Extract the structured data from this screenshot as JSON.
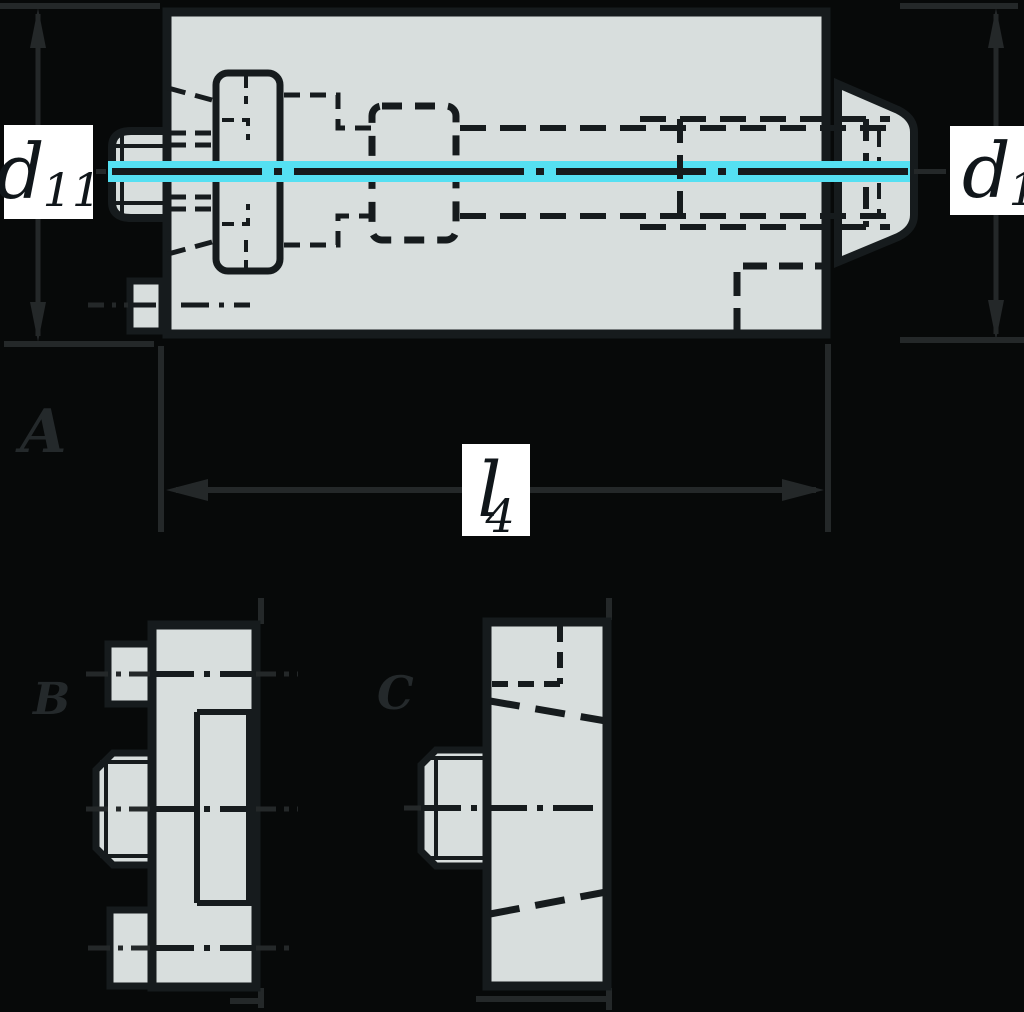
{
  "drawing": {
    "type": "technical-drawing-cross-section",
    "views": {
      "a": {
        "label": "A"
      },
      "b": {
        "label": "B"
      },
      "c": {
        "label": "C"
      }
    },
    "dimensions": {
      "left_diameter": {
        "symbol": "d",
        "subscript": "11"
      },
      "right_diameter": {
        "symbol": "d",
        "subscript": "1"
      },
      "length": {
        "symbol": "l",
        "subscript": "4"
      }
    },
    "colors": {
      "background": "#070909",
      "part_fill": "#d8dedd",
      "part_line": "#161b1d",
      "auxiliary_line": "#242829",
      "centerline_highlight": "#55e0f2",
      "label_background": "#ffffff",
      "label_text": "#10161a"
    }
  }
}
